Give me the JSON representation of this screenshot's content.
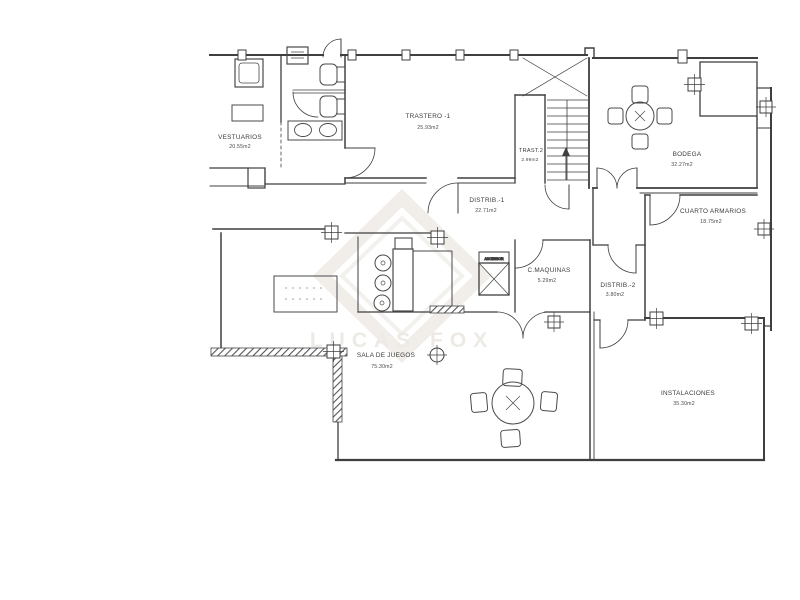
{
  "document": {
    "type": "scanned floor plan",
    "background": "#ffffff"
  },
  "watermark": {
    "text": "LUCAS FOX",
    "shape": "diamond-logo",
    "color": "#efece8"
  },
  "colors": {
    "line": "#3f3f3f",
    "watermark": "#efece8"
  },
  "rooms": {
    "vestuarios": {
      "name": "VESTUARIOS",
      "area": "20.55m2"
    },
    "trastero_1": {
      "name": "TRASTERO -1",
      "area": "25.93m2"
    },
    "trast_2": {
      "name": "TRAST.2",
      "area": "2.99m2"
    },
    "distrib_1": {
      "name": "DISTRIB.-1",
      "area": "22.71m2"
    },
    "bodega": {
      "name": "BODEGA",
      "area": "32.27m2"
    },
    "cuarto_armarios": {
      "name": "CUARTO ARMARIOS",
      "area": "18.75m2"
    },
    "c_maquinas": {
      "name": "C.MAQUINAS",
      "area": "5.29m2"
    },
    "distrib_2": {
      "name": "DISTRIB.-2",
      "area": "3.80m2"
    },
    "sala_de_juegos": {
      "name": "SALA DE JUEGOS",
      "area": "75.30m2"
    },
    "instalaciones": {
      "name": "INSTALACIONES",
      "area": "35.30m2"
    },
    "ascensor": {
      "name": "ASCENSOR"
    }
  }
}
